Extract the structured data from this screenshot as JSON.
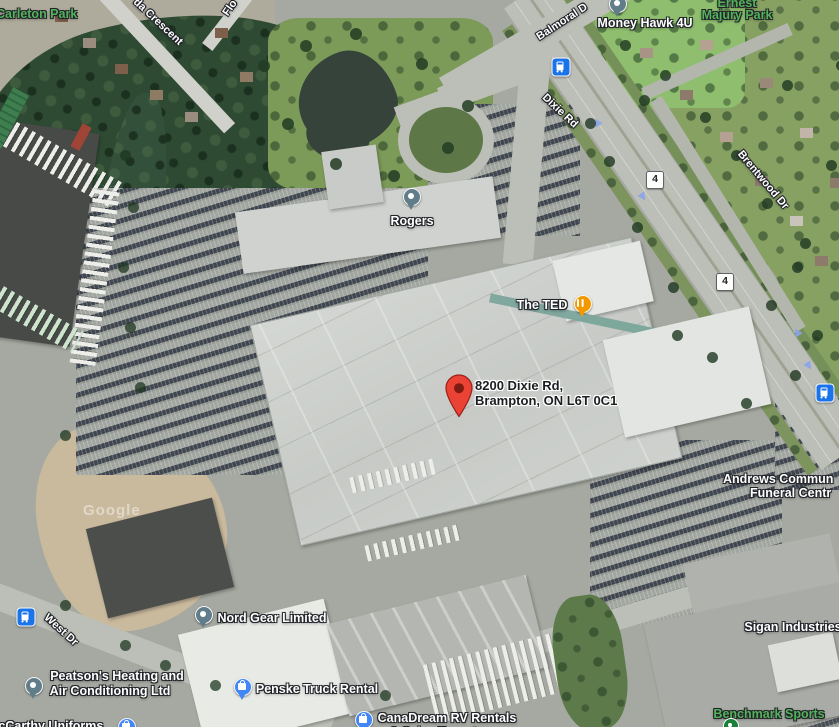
{
  "map": {
    "attribution": "Google",
    "destination": {
      "address_line1": "8200 Dixie Rd,",
      "address_line2": "Brampton, ON L6T 0C1"
    },
    "poi": {
      "money_hawk": "Money Hawk 4U",
      "rogers": "Rogers",
      "the_ted": "The TED",
      "nord_gear": "Nord Gear Limited",
      "peatsons_line1": "Peatson's Heating and",
      "peatsons_line2": "Air Conditioning Ltd",
      "penske": "Penske Truck Rental",
      "canadream_line1": "CanaDream RV Rentals",
      "canadream_line2": "& Sales Toronto",
      "mccarthy": "McCarthy Uniforms",
      "sigan": "Sigan Industries",
      "andrews_line1": "Andrews Commun",
      "andrews_line2": "Funeral Centr"
    },
    "parks": {
      "carleton": "Carleton Park",
      "ernest_line1": "Ernest",
      "ernest_line2": "Majury Park",
      "benchmark": "Benchmark Sports"
    },
    "streets": {
      "da_crescent": "da Crescent",
      "florida": "Flo",
      "balmoral": "Balmoral D",
      "dixie": "Dixie Rd",
      "brentwood": "Brentwood Dr",
      "west": "West Dr"
    },
    "route_badge": "4",
    "colors": {
      "destination_pin": "#EA4335",
      "shopping_pin": "#4285F4",
      "restaurant_pin": "#F29900",
      "poi_pin": "#617D8A",
      "transit_icon": "#1A73E8",
      "park_label_green": "#53B25A"
    }
  }
}
